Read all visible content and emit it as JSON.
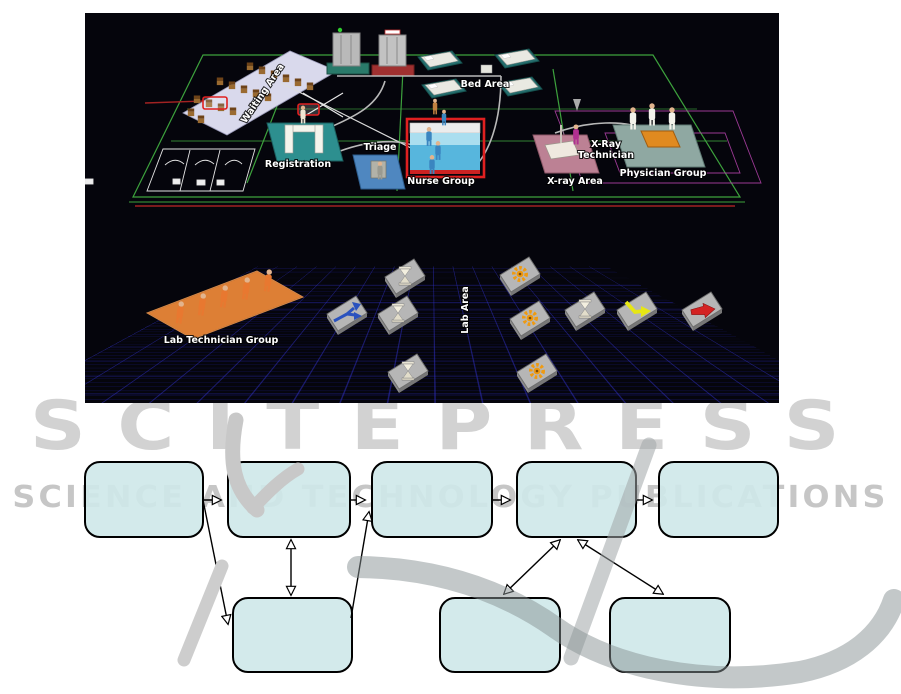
{
  "watermark": {
    "title": "SCITEPRESS",
    "subtitle": "SCIENCE AND TECHNOLOGY PUBLICATIONS",
    "color": "#cccccc"
  },
  "sim_view": {
    "background": "#05050c",
    "grid_color": "#3030cd",
    "selection_color": "#e02020",
    "labels": {
      "waiting_area": "Waiting Area",
      "registration": "Registration",
      "triage": "Triage",
      "nurse_group": "Nurse Group",
      "bed_area": "Bed Area",
      "xray_technician_1": "X-Ray",
      "xray_technician_2": "Technician",
      "xray_area": "X-ray Area",
      "physician_group": "Physician Group",
      "lab_technician_group": "Lab Technician Group",
      "lab_area": "Lab Area"
    },
    "icons": {
      "branch_arrow": "blue split-path arrow tile",
      "hourglass": "gray hourglass wait tile",
      "gear": "orange gear process tile",
      "bent_arrow": "yellow bent route arrow tile",
      "straight_arrow": "red straight exit arrow tile"
    },
    "icon_colors": {
      "branch_arrow": "#2a52be",
      "hourglass": "#f0ecdc",
      "gear": "#ef9a10",
      "bent_arrow": "#e6e614",
      "straight_arrow": "#d42222"
    }
  },
  "flowchart": {
    "box_fill": "rgba(206,232,233,0.9)",
    "box_border": "#000000",
    "top_row_count": 5,
    "bottom_row_count": 3
  }
}
